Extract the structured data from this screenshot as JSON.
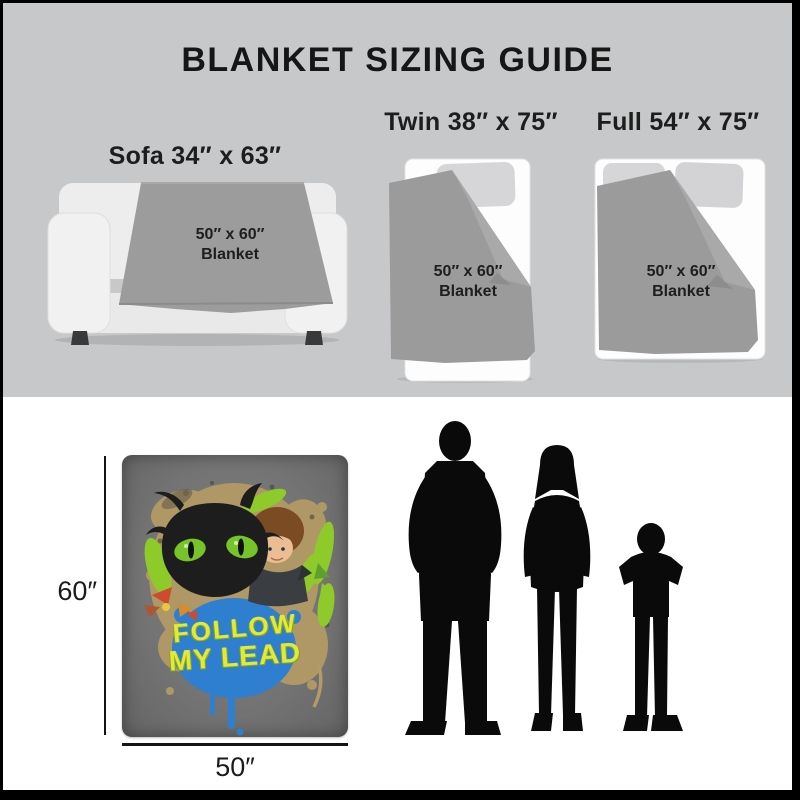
{
  "title": "BLANKET SIZING GUIDE",
  "items": {
    "sofa": {
      "label": "Sofa 34″ x 63″",
      "blanket_size": "50″ x 60″",
      "blanket_word": "Blanket"
    },
    "twin": {
      "label": "Twin 38″ x 75″",
      "blanket_size": "50″ x 60″",
      "blanket_word": "Blanket"
    },
    "full": {
      "label": "Full 54″ x 75″",
      "blanket_size": "50″ x 60″",
      "blanket_word": "Blanket"
    }
  },
  "product": {
    "height_label": "60″",
    "width_label": "50″",
    "art_line1": "FOLLOW",
    "art_line2": "MY LEAD"
  },
  "figures": [
    "adult-man-silhouette",
    "adult-woman-silhouette",
    "child-silhouette"
  ],
  "colors": {
    "frame": "#000000",
    "top_band": "#c7c8ca",
    "furniture_blanket": "#9b9b9c",
    "bed_white": "#fdfdfd",
    "pillow_gray": "#d6d6d8",
    "product_blanket": "#747474",
    "art_yellow": "#e0e93c",
    "art_blue": "#2e7fd0",
    "art_lime": "#8fca2b",
    "art_tan": "#b39a66",
    "silhouette_black": "#0a0a0a",
    "text_black": "#161616"
  }
}
